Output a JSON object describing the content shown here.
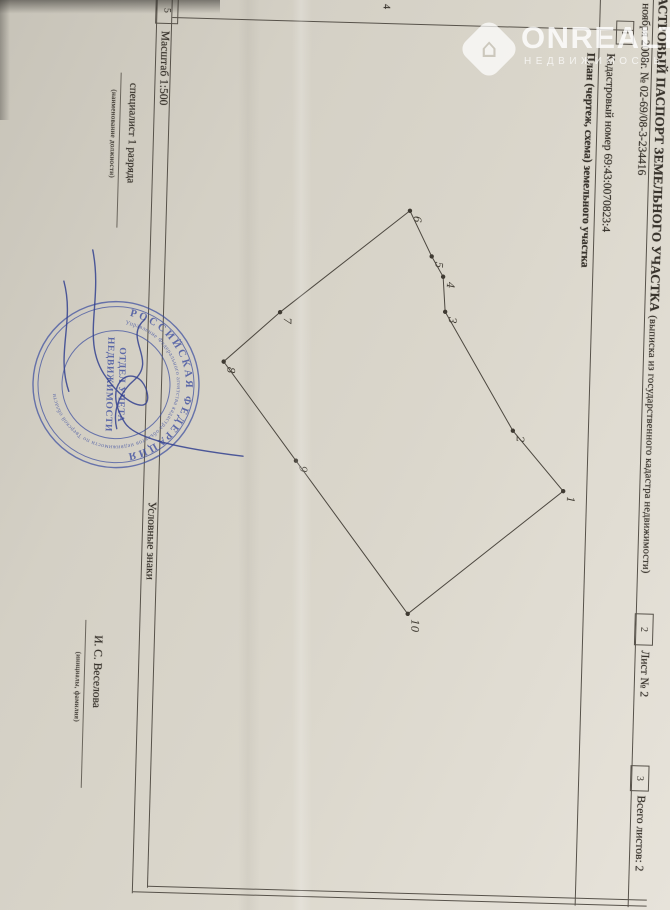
{
  "watermark": {
    "brand": "ONREALT",
    "subtitle": "НЕДВИЖИМОСТЬ",
    "icon": "house-diamond-icon"
  },
  "document": {
    "title": "КАДАСТРОВЫЙ ПАСПОРТ ЗЕМЕЛЬНОГО УЧАСТКА",
    "title_note": "(выписка из государственного кадастра недвижимости)",
    "date_line": "«20» ноября 2008г. № 02-69/08-3-234416",
    "cadastral_label": "Кадастровый номер",
    "cadastral_value": "69:43:0070823:4",
    "sheet_label": "Лист № 2",
    "total_sheets_label": "Всего листов: 2",
    "plan_header": "План (чертеж, схема) земельного участка",
    "scale_label": "Масштаб 1:500",
    "legend_label": "Условные знаки",
    "position_label": "специалист 1 разряда",
    "position_caption": "(наименование должности)",
    "signer_name": "И. С. Веселова",
    "signer_caption": "(инициалы, фамилия)",
    "form_cells": {
      "c1": "1",
      "c2": "2",
      "c3": "3",
      "c4": "4",
      "c5": "5"
    }
  },
  "plan": {
    "vertices": [
      {
        "n": "1",
        "x": 496,
        "y": 95
      },
      {
        "n": "2",
        "x": 437,
        "y": 147
      },
      {
        "n": "3",
        "x": 320,
        "y": 218
      },
      {
        "n": "4",
        "x": 285,
        "y": 221
      },
      {
        "n": "5",
        "x": 265,
        "y": 233
      },
      {
        "n": "6",
        "x": 220,
        "y": 256
      },
      {
        "n": "7",
        "x": 325,
        "y": 383
      },
      {
        "n": "8",
        "x": 376,
        "y": 438
      },
      {
        "n": "9",
        "x": 473,
        "y": 363
      },
      {
        "n": "10",
        "x": 623,
        "y": 247
      }
    ]
  },
  "stamp": {
    "country": "РОССИЙСКАЯ ФЕДЕРАЦИЯ",
    "agency": "Управление Федерального агентства кадастра объектов недвижимости по Тверской области",
    "center_line1": "ОТДЕЛ УЧЕТА",
    "center_line2": "НЕДВИЖИМОСТИ"
  },
  "colors": {
    "paper": "#d7d3c8",
    "ink": "#38332c",
    "table_line": "#57524a",
    "stamp_blue": "#3c4da0",
    "watermark_white": "rgba(255,255,255,0.8)"
  }
}
